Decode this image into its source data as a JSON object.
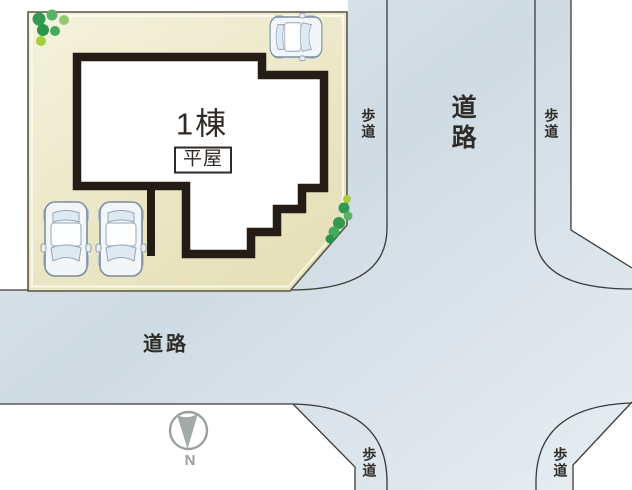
{
  "site_plan": {
    "building": {
      "unit_label": "1棟",
      "story_label": "平屋"
    },
    "roads": {
      "vertical": {
        "label": "道路",
        "sidewalk_top_left": "歩道",
        "sidewalk_top_right": "歩道",
        "sidewalk_bottom_left": "歩道",
        "sidewalk_bottom_right": "歩道"
      },
      "horizontal": {
        "label": "道路"
      }
    },
    "compass": {
      "north_label": "N"
    },
    "icons": [
      "tree-cluster-icon",
      "car-top-view-icon",
      "north-arrow-icon"
    ],
    "colors": {
      "plot_fill": "#ece8c8",
      "road_fill": "#d4dfe6",
      "building_wall": "#251c16",
      "outline": "#3b3b3b",
      "tree_greens": [
        "#2f9a50",
        "#58b269",
        "#a6ce3a"
      ],
      "compass_gray": "#9aa19d"
    }
  }
}
